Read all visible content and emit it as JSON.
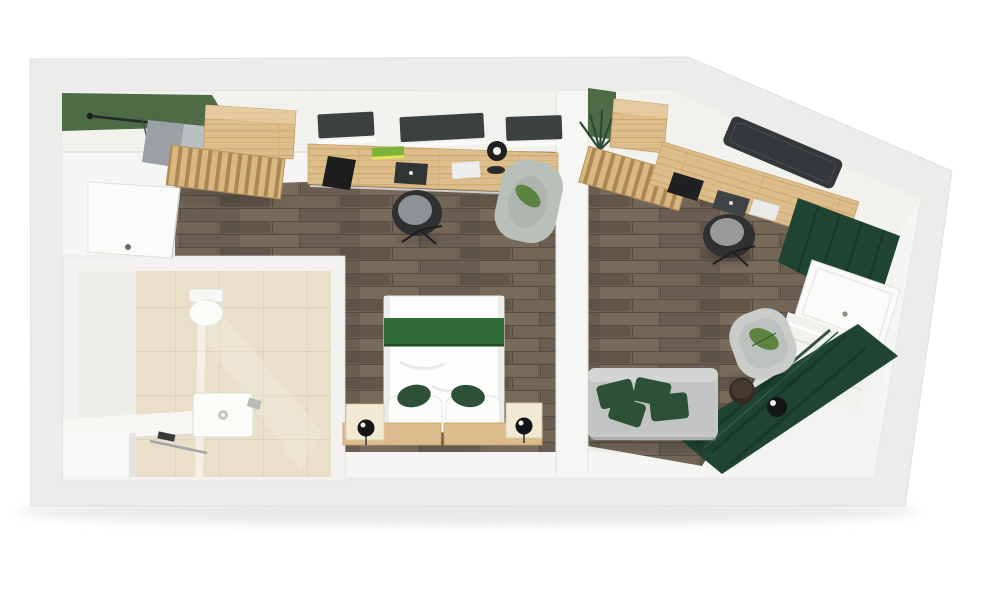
{
  "scene": {
    "kind": "3D rendered top-down floor plan",
    "description": "Aerial render of a two-room suite: entry hall with open wardrobe, bathroom with walk-in shower, bedroom with desk wall and double bed with green runner, second work/living room with corner desk, TV, sofa with green cushions and curtained balcony door",
    "background": "#ffffff"
  },
  "palette": {
    "canvas": "#ffffff",
    "outer_wall_gray": "#ececea",
    "wall_white": "#f5f5f3",
    "accent_green": "#4d6b45",
    "bed_runner_green": "#2f6b36",
    "curtain_green": "#1f4434",
    "cushion_green": "#2c5137",
    "leaf_green": "#5d8340",
    "window_dark": "#3b4041",
    "tv_dark": "#34383a",
    "sofa_gray": "#c6c8c7",
    "chair_dark": "#2e3031",
    "wood_floor_base": "#6e6154",
    "wood_oak_base": "#ddbd8b",
    "tile_beige": "#eadfc9"
  },
  "rooms": [
    {
      "id": "entry",
      "label": "Entry hall",
      "furniture": [
        "entrance-door",
        "green-accent-wall",
        "coat-rail-with-hangers",
        "clothes",
        "dresser-cabinet",
        "slatted-luggage-bench"
      ]
    },
    {
      "id": "bathroom",
      "label": "Bathroom",
      "furniture": [
        "toilet",
        "walk-in-shower",
        "shower-tray",
        "glass-partition",
        "chrome-fixture",
        "towel-rail",
        "bench-ledge"
      ]
    },
    {
      "id": "bedroom",
      "label": "Bedroom and work wall",
      "furniture": [
        "window-panes",
        "wall-desk",
        "desk-accessories",
        "office-chair",
        "floor-lamp",
        "lounge-armchair",
        "double-bed",
        "green-runner",
        "pillows",
        "green-cushions",
        "nightstands",
        "sphere-lamps",
        "headboard-shelf"
      ]
    },
    {
      "id": "second-room",
      "label": "Second room with balcony",
      "furniture": [
        "green-accent-wall",
        "plant",
        "wardrobe-cabinet",
        "slatted-luggage-bench",
        "corner-desk",
        "laptop",
        "office-chair",
        "wall-tv",
        "curtain-bunch",
        "balcony-door",
        "sheer-curtain",
        "curtain-drape",
        "sofa",
        "green-sofa-cushions",
        "lounge-armchair",
        "side-table",
        "sphere-lamp"
      ]
    }
  ]
}
